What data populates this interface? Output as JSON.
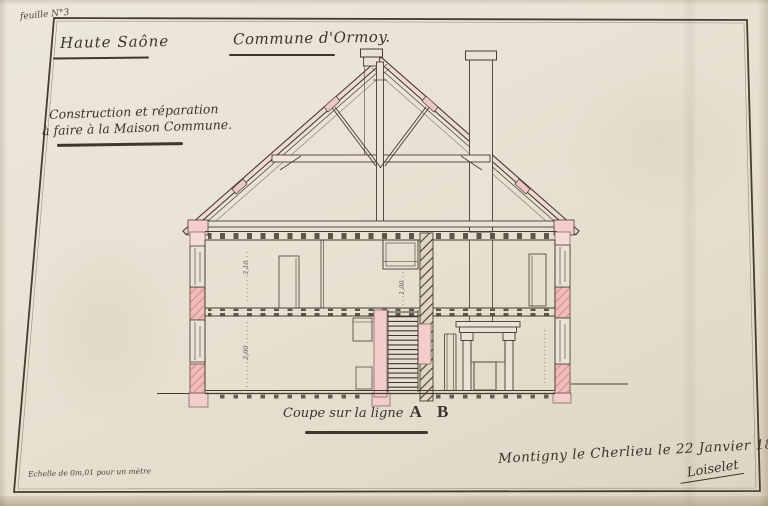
{
  "document": {
    "sheet_label": "feuille N°3",
    "header": {
      "department": "Haute Saône",
      "commune": "Commune d'Ormoy."
    },
    "subject": {
      "line1": "Construction et réparation",
      "line2": "à faire à la Maison Commune."
    },
    "caption": {
      "prefix": "Coupe sur la ligne",
      "section_letters": "A B"
    },
    "footer": {
      "dateline": "Montigny le Cherlieu le 22 Janvier 1836.",
      "signature": "Loiselet",
      "scale_note": "Echelle de 0m,01 pour un mètre"
    },
    "annotations": {
      "dim_upper_room": "3,10",
      "dim_lower_room": "3,00",
      "dim_stair": "1,90"
    }
  },
  "palette": {
    "paper": "#e8e2d4",
    "ink": "#463b2e",
    "handwriting": "#3b342c",
    "wall_pink": "#f2cdcb",
    "wall_pink_deep": "#eebcba",
    "hatch_red": "#c98683",
    "flue_hatch": "#4a3d30",
    "roof_tint": "#eed9d4"
  }
}
